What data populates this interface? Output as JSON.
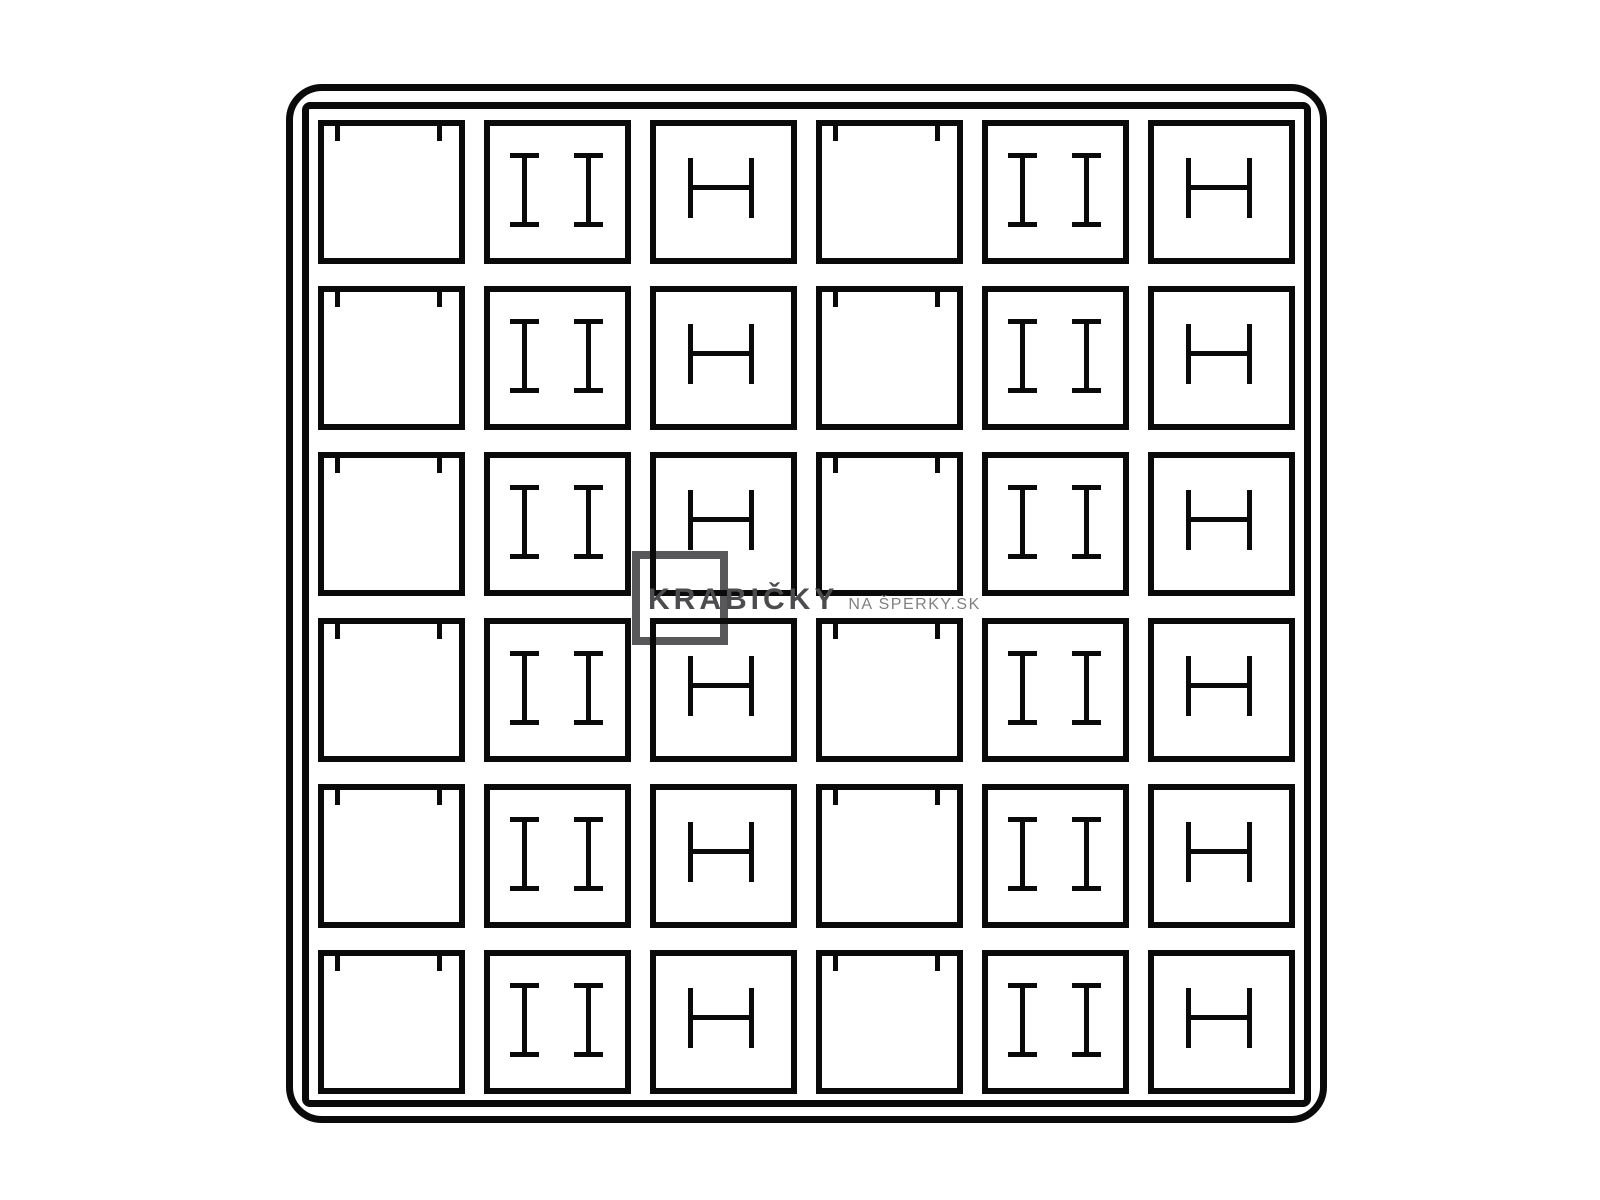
{
  "page": {
    "background_color": "#ffffff"
  },
  "tray": {
    "line_color": "#0a0a0a",
    "rows": 6,
    "columns": 6,
    "grid": [
      [
        "clip-square",
        "double-post",
        "h-slot",
        "clip-square",
        "double-post",
        "h-slot"
      ],
      [
        "clip-square",
        "double-post",
        "h-slot",
        "clip-square",
        "double-post",
        "h-slot"
      ],
      [
        "clip-square",
        "double-post",
        "h-slot",
        "clip-square",
        "double-post",
        "h-slot"
      ],
      [
        "clip-square",
        "double-post",
        "h-slot",
        "clip-square",
        "double-post",
        "h-slot"
      ],
      [
        "clip-square",
        "double-post",
        "h-slot",
        "clip-square",
        "double-post",
        "h-slot"
      ],
      [
        "clip-square",
        "double-post",
        "h-slot",
        "clip-square",
        "double-post",
        "h-slot"
      ]
    ]
  },
  "watermark": {
    "brand_text": "KRABIČKY",
    "suffix_text": "NA ŠPERKY.SK",
    "brand_color": "#4c4c4e",
    "suffix_color": "#808082",
    "logo_square_color": "#58585a"
  }
}
